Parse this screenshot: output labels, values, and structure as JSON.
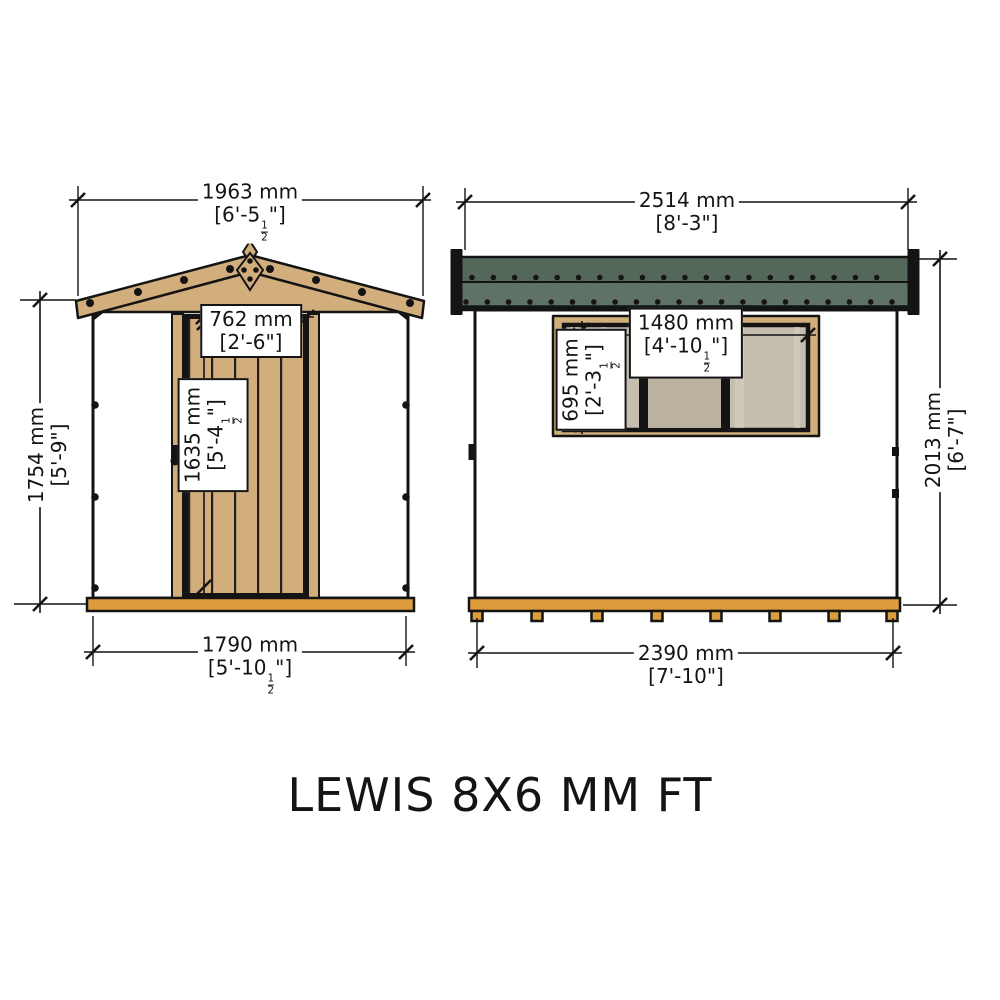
{
  "title": "LEWIS 8X6 MM FT",
  "front_view": {
    "roof_width": {
      "mm": "1963 mm",
      "ft": "[6'-5½\"]"
    },
    "wall_height": {
      "mm": "1754 mm",
      "ft": "[5'-9\"]"
    },
    "door_width": {
      "mm": "762 mm",
      "ft": "[2'-6\"]"
    },
    "door_height": {
      "mm": "1635 mm",
      "ft": "[5'-4½\"]"
    },
    "base_width": {
      "mm": "1790 mm",
      "ft": "[5'-10½\"]"
    }
  },
  "side_view": {
    "roof_width": {
      "mm": "2514 mm",
      "ft": "[8'-3\"]"
    },
    "total_height": {
      "mm": "2013 mm",
      "ft": "[6'-7\"]"
    },
    "window_width": {
      "mm": "1480 mm",
      "ft": "[4'-10½\"]"
    },
    "window_height": {
      "mm": "695 mm",
      "ft": "[2'-3½\"]"
    },
    "base_width": {
      "mm": "2390 mm",
      "ft": "[7'-10\"]"
    }
  },
  "colors": {
    "outline": "#141414",
    "text": "#141414",
    "wood": "#d3ae7d",
    "wood_line": "#1f1f1f",
    "base_orange": "#dd9d3c",
    "roof_green_dark": "#54685a",
    "roof_green_light": "#5e7365",
    "window_pane": "#c5beae",
    "window_pane_mid": "#bab29f",
    "window_streak": "#d8d2c4",
    "label_bg": "#ffffff"
  }
}
